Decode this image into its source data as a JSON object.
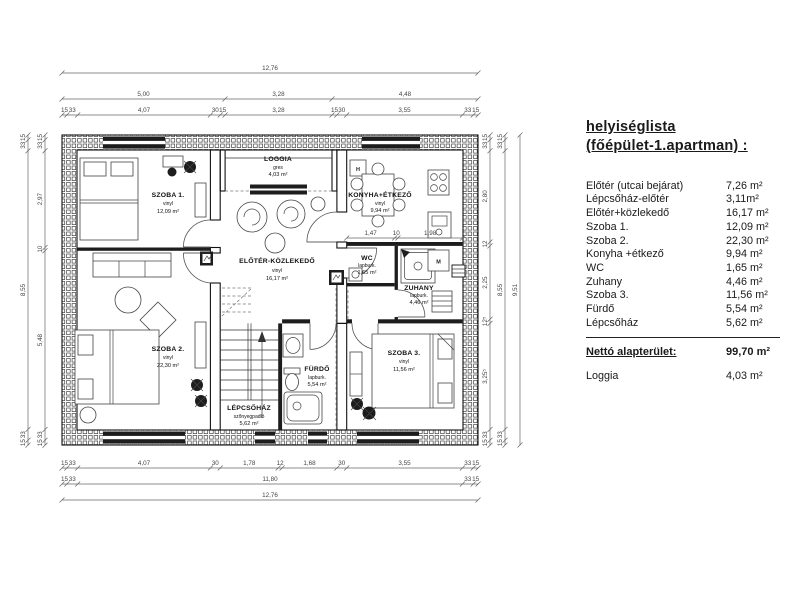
{
  "room_list": {
    "title_line1": "helyiséglista",
    "title_line2": "(főépület-1.apartman) :",
    "rows": [
      {
        "label": "Előtér (utcai bejárat)",
        "value": "7,26 m²"
      },
      {
        "label": "Lépcsőház-előtér",
        "value": "3,11m²"
      },
      {
        "label": "Előtér+közlekedő",
        "value": "16,17 m²"
      },
      {
        "label": "Szoba 1.",
        "value": "12,09 m²"
      },
      {
        "label": "Szoba 2.",
        "value": "22,30 m²"
      },
      {
        "label": "Konyha +étkező",
        "value": "9,94 m²"
      },
      {
        "label": "WC",
        "value": "1,65 m²"
      },
      {
        "label": "Zuhany",
        "value": "4,46 m²"
      },
      {
        "label": "Szoba 3.",
        "value": "11,56 m²"
      },
      {
        "label": "Fürdő",
        "value": "5,54 m²"
      },
      {
        "label": "Lépcsőház",
        "value": "5,62 m²"
      }
    ],
    "total": {
      "label": "Nettó alapterület:",
      "value": "99,70 m²"
    },
    "extra": {
      "label": "Loggia",
      "value": "4,03 m²"
    }
  },
  "plan": {
    "rooms": {
      "szoba1": {
        "name": "SZOBA 1.",
        "finish": "vinyl",
        "area": "12,09 m²"
      },
      "szoba2": {
        "name": "SZOBA 2.",
        "finish": "vinyl",
        "area": "22,30 m²"
      },
      "szoba3": {
        "name": "SZOBA 3.",
        "finish": "vinyl",
        "area": "11,56 m²"
      },
      "loggia": {
        "name": "LOGGIA",
        "finish": "gres",
        "area": "4,03 m²"
      },
      "konyha": {
        "name": "KONYHA+ÉTKEZŐ",
        "finish": "vinyl",
        "area": "9,94 m²"
      },
      "eloter": {
        "name": "ELŐTÉR-KÖZLEKEDŐ",
        "finish": "vinyl",
        "area": "16,17 m²"
      },
      "wc": {
        "name": "WC",
        "finish": "lapburk.",
        "area": "1,65 m²"
      },
      "zuhany": {
        "name": "ZUHANY",
        "finish": "lapburk.",
        "area": "4,46 m²"
      },
      "furdo": {
        "name": "FÜRDŐ",
        "finish": "lapburk.",
        "area": "5,54 m²"
      },
      "lepcsohaz": {
        "name": "LÉPCSŐHÁZ",
        "finish": "szőnyegpadló",
        "area": "5,62 m²"
      }
    },
    "appliances": {
      "fridge": "H",
      "washing_machine": "M"
    },
    "dim_chains": {
      "top_total": [
        {
          "px": 416,
          "t": "12,76"
        }
      ],
      "top_mid": [
        {
          "px": 163,
          "t": "5,00"
        },
        {
          "px": 107,
          "t": "3,28"
        },
        {
          "px": 146,
          "t": "4,48"
        }
      ],
      "top_detail": [
        {
          "px": 4.9,
          "t": "15"
        },
        {
          "px": 10.8,
          "t": "33"
        },
        {
          "px": 132.7,
          "t": "4,07"
        },
        {
          "px": 9.8,
          "t": "30"
        },
        {
          "px": 4.9,
          "t": "15"
        },
        {
          "px": 106.9,
          "t": "3,28"
        },
        {
          "px": 4.9,
          "t": "15"
        },
        {
          "px": 9.8,
          "t": "30"
        },
        {
          "px": 115.7,
          "t": "3,55"
        },
        {
          "px": 10.8,
          "t": "33"
        },
        {
          "px": 4.9,
          "t": "15"
        }
      ],
      "bottom_detail": [
        {
          "px": 4.9,
          "t": "15"
        },
        {
          "px": 10.8,
          "t": "33"
        },
        {
          "px": 132.7,
          "t": "4,07"
        },
        {
          "px": 9.8,
          "t": "30"
        },
        {
          "px": 58,
          "t": "1,78"
        },
        {
          "px": 3.9,
          "t": "12"
        },
        {
          "px": 54.8,
          "t": "1,68"
        },
        {
          "px": 9.8,
          "t": "30"
        },
        {
          "px": 115.7,
          "t": "3,55"
        },
        {
          "px": 10.8,
          "t": "33"
        },
        {
          "px": 4.9,
          "t": "15"
        }
      ],
      "bottom_mid": [
        {
          "px": 4.9,
          "t": "15"
        },
        {
          "px": 10.8,
          "t": "33"
        },
        {
          "px": 384.7,
          "t": "11,80"
        },
        {
          "px": 10.8,
          "t": "33"
        },
        {
          "px": 4.9,
          "t": "15"
        }
      ],
      "bottom_total": [
        {
          "px": 416,
          "t": "12,76"
        }
      ],
      "left_outer": [
        {
          "px": 4.9,
          "t": "15"
        },
        {
          "px": 10.8,
          "t": "33"
        },
        {
          "px": 278.7,
          "t": "8,55"
        },
        {
          "px": 10.8,
          "t": "33"
        },
        {
          "px": 4.9,
          "t": "15"
        }
      ],
      "left_detail": [
        {
          "px": 4.9,
          "t": "15"
        },
        {
          "px": 10.8,
          "t": "33"
        },
        {
          "px": 96.8,
          "t": "2,97"
        },
        {
          "px": 3.3,
          "t": "10"
        },
        {
          "px": 178.7,
          "t": "5,48"
        },
        {
          "px": 10.8,
          "t": "33"
        },
        {
          "px": 4.9,
          "t": "15"
        }
      ],
      "right_detail": [
        {
          "px": 4.9,
          "t": "15"
        },
        {
          "px": 10.8,
          "t": "33"
        },
        {
          "px": 91.3,
          "t": "2,80"
        },
        {
          "px": 3.9,
          "t": "12"
        },
        {
          "px": 73.4,
          "t": "2,25"
        },
        {
          "px": 4.1,
          "t": "12⁵"
        },
        {
          "px": 106.1,
          "t": "3,25⁵"
        },
        {
          "px": 10.8,
          "t": "33"
        },
        {
          "px": 4.9,
          "t": "15"
        }
      ],
      "right_mid": [
        {
          "px": 4.9,
          "t": "15"
        },
        {
          "px": 10.8,
          "t": "33"
        },
        {
          "px": 278.7,
          "t": "8,55"
        },
        {
          "px": 10.8,
          "t": "33"
        },
        {
          "px": 4.9,
          "t": "15"
        }
      ],
      "right_total": [
        {
          "px": 310,
          "t": "9,51"
        }
      ],
      "konyha_inner": [
        {
          "px": 47.9,
          "t": "1,47"
        },
        {
          "px": 3.3,
          "t": "10"
        },
        {
          "px": 64.6,
          "t": "1,98"
        }
      ]
    }
  }
}
